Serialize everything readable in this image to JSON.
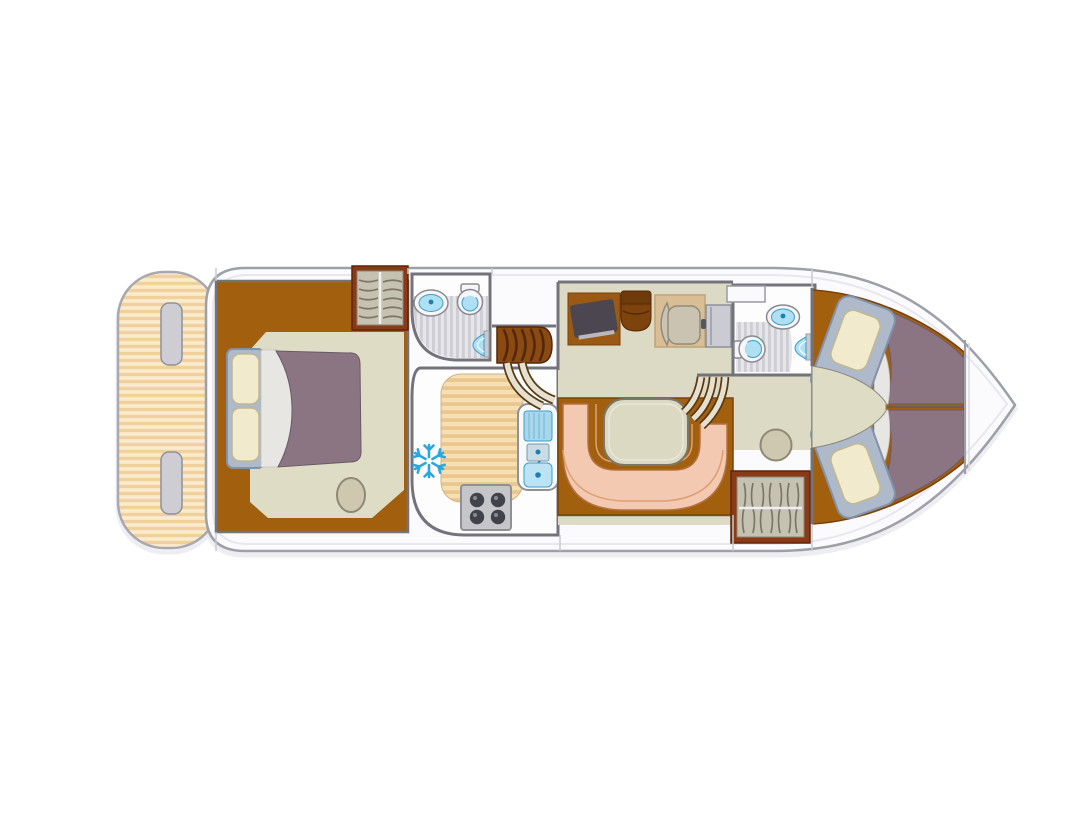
{
  "meta": {
    "kind": "boat-floor-plan",
    "view": "top-down-deck-plan"
  },
  "rooms": [
    "aft-deck",
    "owner-cabin",
    "bathroom-aft",
    "galley",
    "saloon-helm",
    "dinette",
    "corridor",
    "bathroom-fwd",
    "bow-cabin"
  ],
  "icons": [
    "fridge-snowflake-icon",
    "sink-icon",
    "toilet-icon",
    "shower-icon",
    "stove-burner-icon",
    "hanger-icon",
    "steps-icon",
    "helm-console-icon",
    "tv-icon"
  ],
  "furniture": {
    "owner_cabin": [
      "double-bed",
      "wardrobe",
      "stool"
    ],
    "galley": [
      "counter",
      "stove",
      "sink",
      "fridge"
    ],
    "saloon": [
      "tv-cabinet",
      "bench-seat",
      "helm-chair",
      "helm-console"
    ],
    "dinette": [
      "u-shaped-bench",
      "table"
    ],
    "bow_cabin": [
      "berth-port",
      "berth-starboard"
    ],
    "corridor": [
      "wardrobe",
      "stool"
    ]
  },
  "colors": {
    "hullFill": "#FBFBFD",
    "hullStroke": "#9EA0A8",
    "hullInner": "#E7E7ED",
    "teakLight": "#FAEBCE",
    "teakDark": "#F0D19C",
    "deckStroke": "#A8A8B0",
    "counterLight": "#F6DFB2",
    "counterDark": "#E9C88F",
    "stepTab": "#CDCDD3",
    "wood": "#A2600F",
    "woodDark": "#7A4208",
    "floorBeige": "#DFDCC6",
    "saloonBeige": "#DCD9C4",
    "wall": "#73737C",
    "wallLight": "#C9C9CF",
    "mauve": "#8B7583",
    "mauveDark": "#6B5966",
    "bedFrame": "#AEB9C9",
    "bedFrameStroke": "#8292A8",
    "pillow": "#F1EACC",
    "pillowStroke": "#C2B892",
    "sheet": "#E7E6E3",
    "sheetEdge": "#C2C1BE",
    "salmon": "#F4C9B1",
    "salmonStroke": "#B5703F",
    "salmonSeam": "#DCA075",
    "tableFill": "#DBD9C2",
    "tableStroke": "#77776B",
    "stairBrown": "#8A4A12",
    "stairDark": "#53280A",
    "railCream": "#E5E0CF",
    "railEdge": "#5A3A14",
    "showerA": "#E6E6EA",
    "showerB": "#CDCDD4",
    "fixtureBlue": "#AEDFF2",
    "fixtureBlueDark": "#3D9CC8",
    "fixtureDot": "#1B7FB0",
    "fixtureWhite": "#F6F6F8",
    "snow": "#2BA7DD",
    "stoveBody": "#C6C6CA",
    "stoveStroke": "#8F8F96",
    "knob": "#42424A",
    "mat": "#D9BE95",
    "matStroke": "#C0A478",
    "chair": "#CBC3B1",
    "chairStroke": "#8F8B7C",
    "console": "#CBCBD3",
    "consoleStroke": "#8F8F98",
    "tv": "#4B4650",
    "desk": "#9A5A14",
    "seatBrown": "#7E420D",
    "wardrobeFrame": "#8A3A16",
    "wardrobeInner": "#C6C2B2",
    "hanger": "#7D7666",
    "rail": "#EFEFF2",
    "stool": "#CFC8B0",
    "stoolStroke": "#8F8874",
    "sinkDrain": "#A9D6EA",
    "basin": "#BCE3F3"
  }
}
